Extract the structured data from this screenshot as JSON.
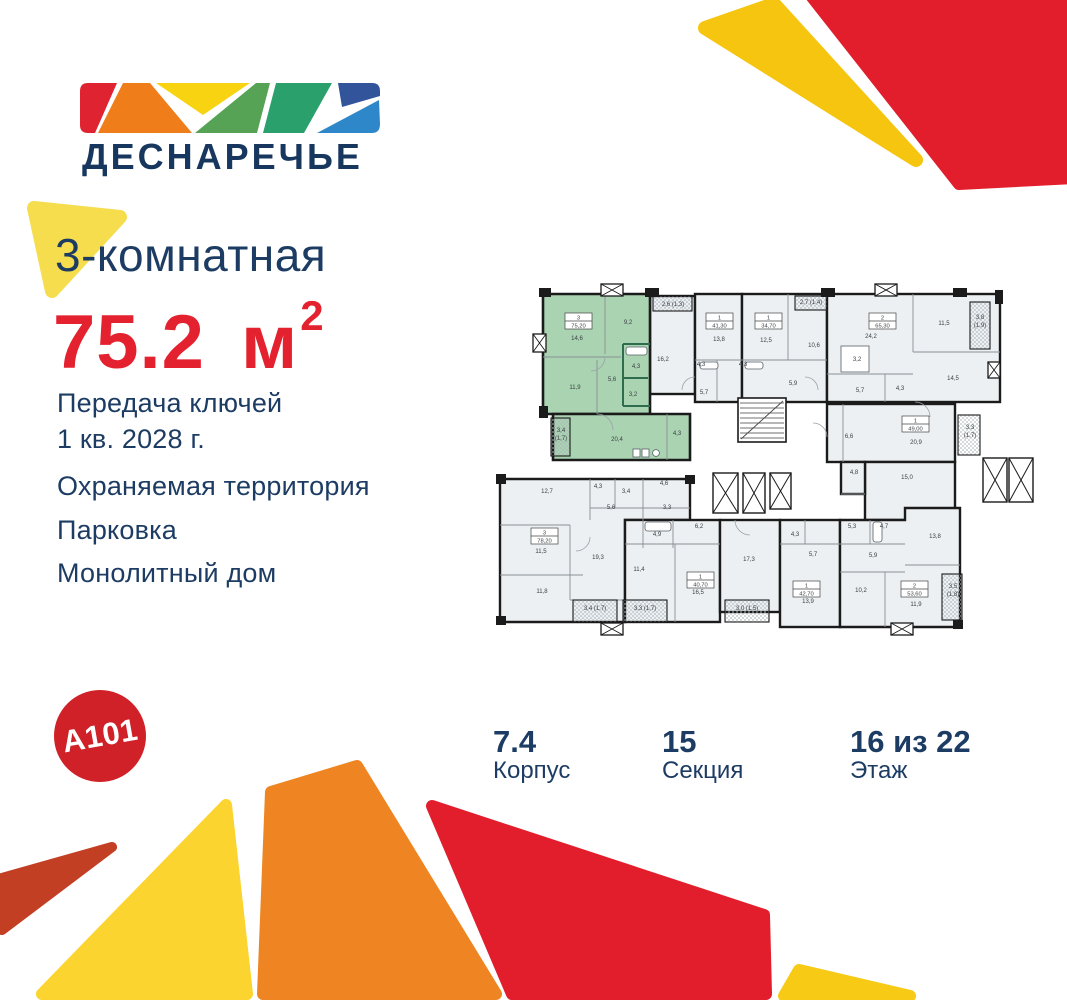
{
  "logo": {
    "name": "ДЕСНАРЕЧЬЕ"
  },
  "developer": {
    "brand": "A101"
  },
  "listing": {
    "type": "3-комнатная",
    "area_value": "75.2",
    "area_unit": "м",
    "area_sup": "2",
    "handover_line1": "Передача ключей",
    "handover_line2": "1 кв. 2028 г.",
    "features": [
      "Охраняемая территория",
      "Парковка",
      "Монолитный дом"
    ]
  },
  "stats": [
    {
      "value": "7.4",
      "label": "Корпус"
    },
    {
      "value": "15",
      "label": "Секция"
    },
    {
      "value": "16 из 22",
      "label": "Этаж"
    }
  ],
  "colors": {
    "navy": "#1d3c63",
    "accent_red": "#e4212e",
    "brand_red": "#d02028",
    "highlight_green": "#a9d3b1",
    "unit_gray": "#ecf0f2",
    "wall": "#1b1b1b"
  },
  "floorplan": {
    "unit_boxes": [
      {
        "x": 70,
        "y": 31,
        "num": "3",
        "area": "75,20"
      },
      {
        "x": 211,
        "y": 31,
        "num": "1",
        "area": "41,30"
      },
      {
        "x": 260,
        "y": 31,
        "num": "1",
        "area": "34,70"
      },
      {
        "x": 374,
        "y": 31,
        "num": "2",
        "area": "65,30"
      },
      {
        "x": 407,
        "y": 134,
        "num": "1",
        "area": "49,00"
      },
      {
        "x": 36,
        "y": 246,
        "num": "3",
        "area": "78,20"
      },
      {
        "x": 192,
        "y": 290,
        "num": "1",
        "area": "40,70"
      },
      {
        "x": 298,
        "y": 299,
        "num": "1",
        "area": "42,70"
      },
      {
        "x": 406,
        "y": 299,
        "num": "2",
        "area": "53,60"
      }
    ],
    "labels": [
      {
        "x": 82,
        "y": 58,
        "t": "14,6"
      },
      {
        "x": 133,
        "y": 42,
        "t": "9,2"
      },
      {
        "x": 80,
        "y": 107,
        "t": "11,9"
      },
      {
        "x": 117,
        "y": 99,
        "t": "5,6"
      },
      {
        "x": 141,
        "y": 86,
        "t": "4,3"
      },
      {
        "x": 138,
        "y": 114,
        "t": "3,2"
      },
      {
        "x": 122,
        "y": 159,
        "t": "20,4"
      },
      {
        "x": 182,
        "y": 153,
        "t": "4,3"
      },
      {
        "x": 66,
        "y": 150,
        "t": "3,4"
      },
      {
        "x": 66,
        "y": 158,
        "t": "(1,7)"
      },
      {
        "x": 168,
        "y": 79,
        "t": "16,2"
      },
      {
        "x": 178,
        "y": 24,
        "t": "2,6 (1,3)"
      },
      {
        "x": 224,
        "y": 59,
        "t": "13,8"
      },
      {
        "x": 206,
        "y": 84,
        "t": "4,3"
      },
      {
        "x": 209,
        "y": 112,
        "t": "5,7"
      },
      {
        "x": 271,
        "y": 60,
        "t": "12,5"
      },
      {
        "x": 319,
        "y": 65,
        "t": "10,6"
      },
      {
        "x": 316,
        "y": 22,
        "t": "2,7 (1,4)"
      },
      {
        "x": 298,
        "y": 103,
        "t": "5,9"
      },
      {
        "x": 248,
        "y": 84,
        "t": "4,3"
      },
      {
        "x": 376,
        "y": 56,
        "t": "24,2"
      },
      {
        "x": 362,
        "y": 79,
        "t": "3,2"
      },
      {
        "x": 449,
        "y": 43,
        "t": "11,5"
      },
      {
        "x": 485,
        "y": 37,
        "t": "3,8"
      },
      {
        "x": 485,
        "y": 45,
        "t": "(1,9)"
      },
      {
        "x": 458,
        "y": 98,
        "t": "14,5"
      },
      {
        "x": 365,
        "y": 110,
        "t": "5,7"
      },
      {
        "x": 405,
        "y": 108,
        "t": "4,3"
      },
      {
        "x": 421,
        "y": 162,
        "t": "20,9"
      },
      {
        "x": 354,
        "y": 156,
        "t": "6,6"
      },
      {
        "x": 475,
        "y": 147,
        "t": "3,3"
      },
      {
        "x": 475,
        "y": 155,
        "t": "(1,7)"
      },
      {
        "x": 412,
        "y": 197,
        "t": "15,0"
      },
      {
        "x": 359,
        "y": 192,
        "t": "4,8"
      },
      {
        "x": 52,
        "y": 211,
        "t": "12,7"
      },
      {
        "x": 46,
        "y": 271,
        "t": "11,5"
      },
      {
        "x": 47,
        "y": 311,
        "t": "11,8"
      },
      {
        "x": 103,
        "y": 277,
        "t": "19,3"
      },
      {
        "x": 116,
        "y": 227,
        "t": "5,6"
      },
      {
        "x": 103,
        "y": 206,
        "t": "4,3"
      },
      {
        "x": 131,
        "y": 211,
        "t": "3,4"
      },
      {
        "x": 169,
        "y": 203,
        "t": "4,6"
      },
      {
        "x": 172,
        "y": 227,
        "t": "3,3"
      },
      {
        "x": 100,
        "y": 328,
        "t": "3,4 (1,7)"
      },
      {
        "x": 150,
        "y": 328,
        "t": "3,3 (1,7)"
      },
      {
        "x": 252,
        "y": 328,
        "t": "3,0 (1,5)"
      },
      {
        "x": 144,
        "y": 289,
        "t": "11,4"
      },
      {
        "x": 203,
        "y": 312,
        "t": "16,5"
      },
      {
        "x": 162,
        "y": 254,
        "t": "4,9"
      },
      {
        "x": 204,
        "y": 246,
        "t": "6,2"
      },
      {
        "x": 254,
        "y": 279,
        "t": "17,3"
      },
      {
        "x": 313,
        "y": 321,
        "t": "13,9"
      },
      {
        "x": 318,
        "y": 274,
        "t": "5,7"
      },
      {
        "x": 300,
        "y": 254,
        "t": "4,3"
      },
      {
        "x": 366,
        "y": 310,
        "t": "10,2"
      },
      {
        "x": 421,
        "y": 324,
        "t": "11,9"
      },
      {
        "x": 378,
        "y": 275,
        "t": "5,9"
      },
      {
        "x": 357,
        "y": 246,
        "t": "5,3"
      },
      {
        "x": 389,
        "y": 246,
        "t": "4,7"
      },
      {
        "x": 440,
        "y": 256,
        "t": "13,8"
      },
      {
        "x": 458,
        "y": 306,
        "t": "3,5"
      },
      {
        "x": 458,
        "y": 314,
        "t": "(1,8)"
      }
    ]
  }
}
